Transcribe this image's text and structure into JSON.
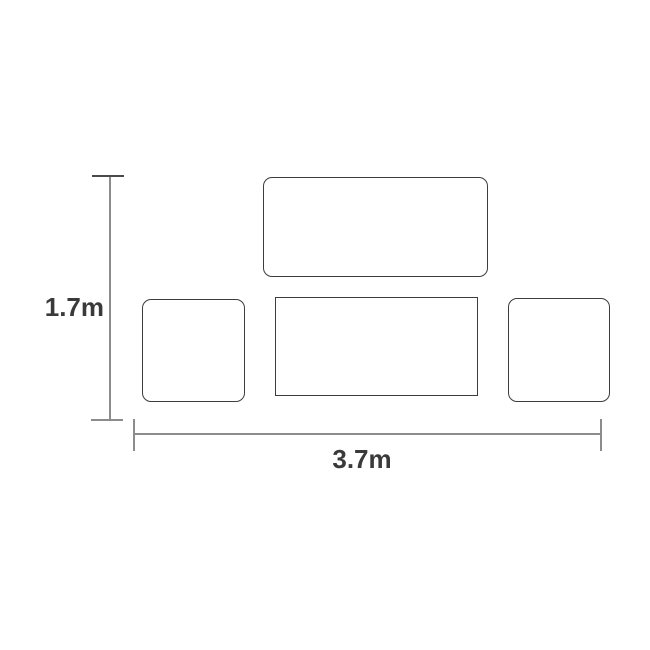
{
  "diagram": {
    "type": "dimension-drawing",
    "dimensions": {
      "height_label": "1.7m",
      "width_label": "3.7m"
    },
    "shapes": [
      {
        "name": "top-rectangle"
      },
      {
        "name": "left-square"
      },
      {
        "name": "center-rectangle"
      },
      {
        "name": "right-square"
      }
    ],
    "colors": {
      "background": "#ffffff",
      "shape_border": "#3d3d3d",
      "dimension_line": "#8c8c8c",
      "label_text": "#3a3a3a"
    }
  }
}
